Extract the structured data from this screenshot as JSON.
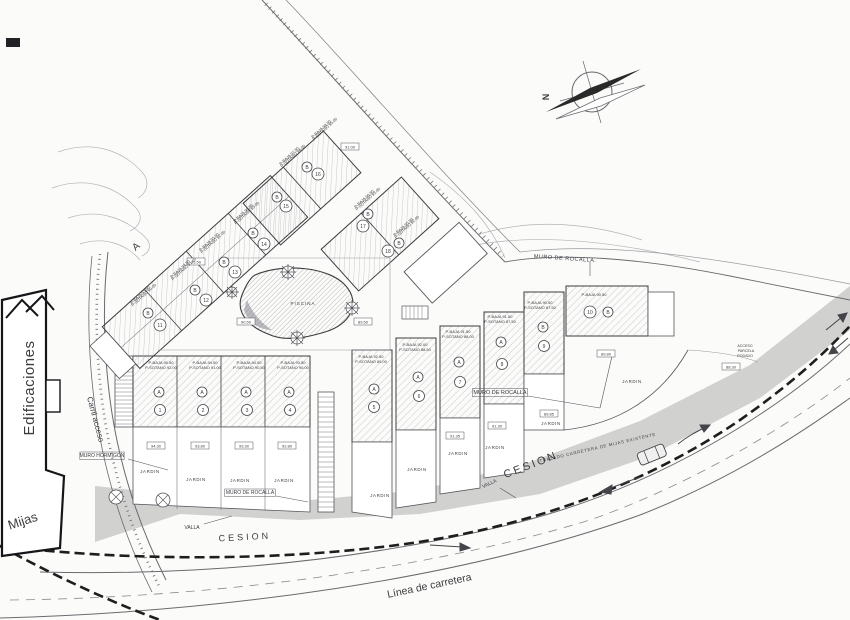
{
  "plan": {
    "type": "architectural-site-plan",
    "colors": {
      "paper": "#fbfbf9",
      "ink": "#3c3c40",
      "line": "#55555a",
      "light_line": "#9a9aa2",
      "hatch": "#9a9aa2",
      "cession_band": "#c9c9c9",
      "boundary": "#1e1e1e",
      "needle": "#2a2a2a"
    },
    "compass": {
      "north_label": "N"
    },
    "garden_label": "JARDIN",
    "garden_positions": [
      [
        150,
        473
      ],
      [
        196,
        481
      ],
      [
        240,
        482
      ],
      [
        284,
        482
      ],
      [
        380,
        497
      ],
      [
        417,
        471
      ],
      [
        458,
        455
      ],
      [
        495,
        449
      ],
      [
        551,
        425
      ],
      [
        632,
        383
      ]
    ],
    "labels": [
      {
        "id": "edificaciones",
        "text": "Edificaciones",
        "x": 34,
        "y": 388,
        "rot": -90,
        "size": 15,
        "ls": 0.5
      },
      {
        "id": "section-a",
        "text": "A",
        "x": 138,
        "y": 249,
        "rot": -40,
        "size": 10
      },
      {
        "id": "mijas",
        "text": "Mijas",
        "x": 24,
        "y": 525,
        "rot": -18,
        "size": 13
      },
      {
        "id": "carril-acceso",
        "text": "Carril acceso",
        "x": 93,
        "y": 420,
        "rot": 75,
        "size": 8
      },
      {
        "id": "cesion-1",
        "text": "CESION",
        "x": 245,
        "y": 540,
        "rot": -3,
        "size": 9,
        "ls": 3
      },
      {
        "id": "cesion-2",
        "text": "CESION",
        "x": 532,
        "y": 468,
        "rot": -21,
        "size": 11,
        "ls": 2.5
      },
      {
        "id": "linea-carretera",
        "text": "Línea de carretera",
        "x": 430,
        "y": 589,
        "rot": -12,
        "size": 10.5
      },
      {
        "id": "trazado-carretera",
        "text": "TRAZADO CARRETERA DE MIJAS EXISTENTE",
        "x": 598,
        "y": 449,
        "rot": -13,
        "size": 4.3,
        "ls": 0.7
      },
      {
        "id": "piscina",
        "text": "PISCINA",
        "x": 303,
        "y": 305,
        "size": 4.5,
        "ls": 1
      },
      {
        "id": "muro-hormigon",
        "text": "MURO HORMIGON",
        "x": 102,
        "y": 457,
        "size": 5,
        "box": true
      },
      {
        "id": "muro-rocalla-1",
        "text": "MURO DE ROCALLA.",
        "x": 565,
        "y": 260,
        "rot": 4,
        "size": 5.5,
        "ls": 0.5
      },
      {
        "id": "muro-rocalla-2",
        "text": "MURO DE ROCALLA",
        "x": 500,
        "y": 394,
        "size": 5.5,
        "box": true
      },
      {
        "id": "muro-rocalla-3",
        "text": "MURO DE ROCALLA",
        "x": 250,
        "y": 494,
        "size": 5,
        "box": true
      },
      {
        "id": "valla-1",
        "text": "VALLA",
        "x": 192,
        "y": 529,
        "size": 5
      },
      {
        "id": "valla-2",
        "text": "VALLA",
        "x": 490,
        "y": 485,
        "rot": -25,
        "size": 5
      },
      {
        "id": "acceso-1",
        "text": "ACCESO",
        "x": 745,
        "y": 347,
        "size": 3.6
      },
      {
        "id": "acceso-2",
        "text": "PARCELA",
        "x": 746,
        "y": 352,
        "size": 3.6
      },
      {
        "id": "acceso-3",
        "text": "RODADO",
        "x": 745,
        "y": 357,
        "size": 3.6
      }
    ],
    "spot_elevations": [
      {
        "v": "91.00",
        "x": 350,
        "y": 147
      },
      {
        "v": "95.50",
        "x": 196,
        "y": 262
      },
      {
        "v": "90.50",
        "x": 246,
        "y": 322
      },
      {
        "v": "89.50",
        "x": 363,
        "y": 322
      },
      {
        "v": "89.80",
        "x": 606,
        "y": 354
      },
      {
        "v": "88.30",
        "x": 731,
        "y": 367
      },
      {
        "v": "94.30",
        "x": 156,
        "y": 446
      },
      {
        "v": "93.80",
        "x": 200,
        "y": 446
      },
      {
        "v": "93.30",
        "x": 244,
        "y": 446
      },
      {
        "v": "92.80",
        "x": 287,
        "y": 446
      },
      {
        "v": "91.35",
        "x": 455,
        "y": 436
      },
      {
        "v": "91.30",
        "x": 497,
        "y": 426
      },
      {
        "v": "89.85",
        "x": 549,
        "y": 414
      }
    ],
    "units": [
      {
        "n": "1",
        "letter": "A",
        "l1": "P-BAJA 95.50",
        "l2": "P-SOTANO 92.00",
        "ann": [
          161,
          364
        ],
        "rot": 0,
        "lc": [
          159,
          392
        ],
        "nc": [
          160,
          410
        ]
      },
      {
        "n": "2",
        "letter": "A",
        "l1": "P-BAJA 94.50",
        "l2": "P-SOTANO 91.00",
        "ann": [
          205,
          364
        ],
        "rot": 0,
        "lc": [
          202,
          392
        ],
        "nc": [
          203,
          410
        ]
      },
      {
        "n": "3",
        "letter": "A",
        "l1": "P-BAJA 94.00",
        "l2": "P-SOTANO 90.50",
        "ann": [
          249,
          364
        ],
        "rot": 0,
        "lc": [
          246,
          392
        ],
        "nc": [
          247,
          410
        ]
      },
      {
        "n": "4",
        "letter": "A",
        "l1": "P-BAJA 93.50",
        "l2": "P-SOTANO 90.00",
        "ann": [
          293,
          364
        ],
        "rot": 0,
        "lc": [
          289,
          392
        ],
        "nc": [
          290,
          410
        ]
      },
      {
        "n": "5",
        "letter": "A",
        "l1": "P-BAJA 92.50",
        "l2": "P-SOTANO 89.00",
        "ann": [
          371,
          358
        ],
        "rot": 0,
        "lc": [
          374,
          389
        ],
        "nc": [
          374,
          407
        ]
      },
      {
        "n": "6",
        "letter": "A",
        "l1": "P-BAJA 92.00",
        "l2": "P-SOTANO 88.50",
        "ann": [
          415,
          346
        ],
        "rot": 0,
        "lc": [
          418,
          377
        ],
        "nc": [
          419,
          396
        ]
      },
      {
        "n": "7",
        "letter": "A",
        "l1": "P-BAJA 91.50",
        "l2": "P-SOTANO 88.00",
        "ann": [
          458,
          333
        ],
        "rot": 0,
        "lc": [
          459,
          362
        ],
        "nc": [
          460,
          382
        ]
      },
      {
        "n": "8",
        "letter": "A",
        "l1": "P-BAJA 91.50",
        "l2": "P-SOTANO 87.50",
        "ann": [
          500,
          318
        ],
        "rot": 0,
        "lc": [
          501,
          342
        ],
        "nc": [
          502,
          364
        ]
      },
      {
        "n": "9",
        "letter": "B",
        "l1": "P-BAJA 90.50",
        "l2": "P-SOTANO 87.50",
        "ann": [
          540,
          304
        ],
        "rot": 0,
        "lc": [
          543,
          327
        ],
        "nc": [
          544,
          346
        ]
      },
      {
        "n": "10",
        "letter": "B",
        "l1": "P-BAJA 90.50",
        "l2": "",
        "ann": [
          594,
          296
        ],
        "rot": 0,
        "lc": [
          608,
          312
        ],
        "nc": [
          590,
          312
        ]
      },
      {
        "n": "11",
        "letter": "B",
        "l1": "P-BAJA 93.50",
        "l2": "P-SOTANO 90.00",
        "ann": [
          141,
          296
        ],
        "rot": -42,
        "lc": [
          148,
          313
        ],
        "nc": [
          160,
          325
        ]
      },
      {
        "n": "12",
        "letter": "B",
        "l1": "P-BAJA 94.50",
        "l2": "P-SOTANO 91.00",
        "ann": [
          181,
          270
        ],
        "rot": -42,
        "lc": [
          195,
          290
        ],
        "nc": [
          206,
          300
        ]
      },
      {
        "n": "13",
        "letter": "B",
        "l1": "P-BAJA 95.50",
        "l2": "P-SOTANO 92.00",
        "ann": [
          210,
          243
        ],
        "rot": -42,
        "lc": [
          224,
          262
        ],
        "nc": [
          235,
          272
        ]
      },
      {
        "n": "14",
        "letter": "B",
        "l1": "P-BAJA 96.50",
        "l2": "P-SOTANO 93.00",
        "ann": [
          244,
          214
        ],
        "rot": -42,
        "lc": [
          253,
          233
        ],
        "nc": [
          264,
          244
        ]
      },
      {
        "n": "15",
        "letter": "B",
        "l1": "P-BAJA 97.50",
        "l2": "P-SOTANO 94.00",
        "ann": [
          290,
          157
        ],
        "rot": -42,
        "lc": [
          277,
          197
        ],
        "nc": [
          286,
          206
        ]
      },
      {
        "n": "16",
        "letter": "B",
        "l1": "P-BAJA 98.50",
        "l2": "P-SOTANO 95.00",
        "ann": [
          322,
          130
        ],
        "rot": -42,
        "lc": [
          307,
          167
        ],
        "nc": [
          318,
          174
        ]
      },
      {
        "n": "17",
        "letter": "B",
        "l1": "P-BAJA 96.50",
        "l2": "P-SOTANO 93.00",
        "ann": [
          365,
          200
        ],
        "rot": -42,
        "lc": [
          368,
          214
        ],
        "nc": [
          363,
          226
        ]
      },
      {
        "n": "18",
        "letter": "B",
        "l1": "P-BAJA 95.50",
        "l2": "P-SOTANO 92.00",
        "ann": [
          404,
          228
        ],
        "rot": -42,
        "lc": [
          399,
          243
        ],
        "nc": [
          388,
          251
        ]
      }
    ]
  }
}
